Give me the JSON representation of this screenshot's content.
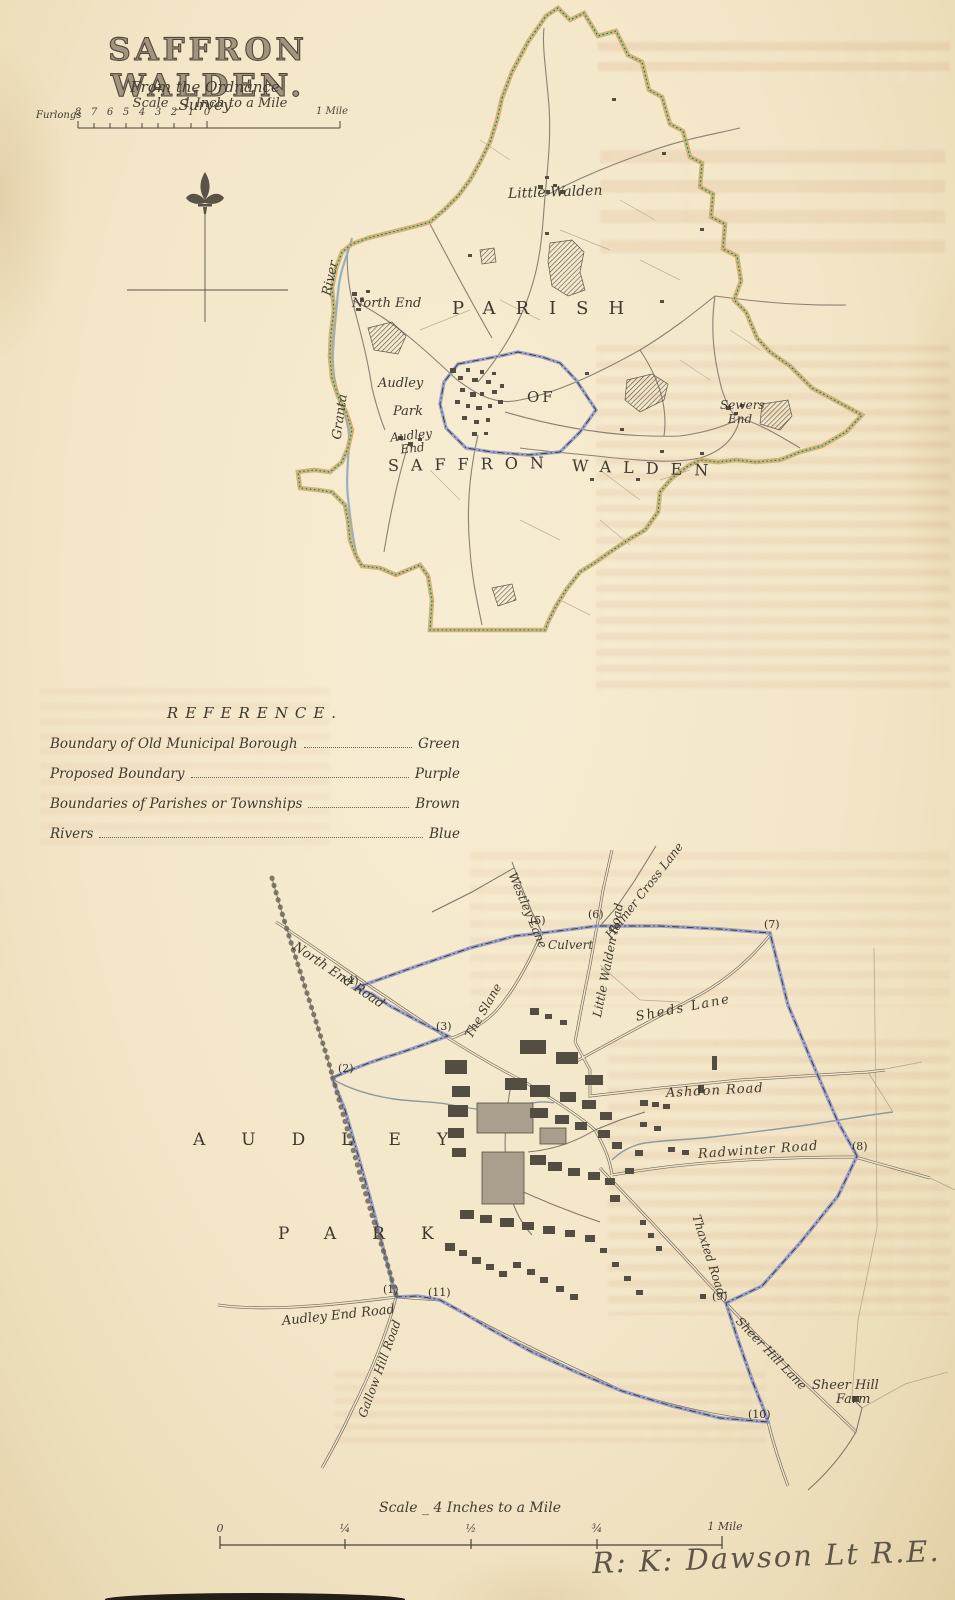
{
  "page": {
    "title": "SAFFRON WALDEN.",
    "subtitle": "From the Ordnance Survey",
    "signature": "R: K: Dawson Lt R.E."
  },
  "scale_top": {
    "label": "Scale _ 1 Inch to a Mile",
    "unit": "Furlongs",
    "ticks": [
      "8",
      "7",
      "6",
      "5",
      "4",
      "3",
      "2",
      "1",
      "0"
    ],
    "mile": "1 Mile"
  },
  "scale_bottom": {
    "label": "Scale _ 4 Inches to a Mile",
    "ticks": [
      "0",
      "¼",
      "½",
      "¾"
    ],
    "mile": "1 Mile"
  },
  "reference": {
    "heading": "REFERENCE.",
    "rows": [
      {
        "label": "Boundary of Old Municipal Borough",
        "value": "Green"
      },
      {
        "label": "Proposed Boundary",
        "value": "Purple"
      },
      {
        "label": "Boundaries of Parishes or Townships",
        "value": "Brown"
      },
      {
        "label": "Rivers",
        "value": "Blue"
      }
    ]
  },
  "parish_map": {
    "labels": {
      "river_line1": "River",
      "river_line2": "Granta",
      "north_end": "North End",
      "little_walden": "Little Walden",
      "parish": "PARISH",
      "of": "OF",
      "audley": "Audley",
      "park": "Park",
      "audley_end": "Audley End",
      "saffron": "SAFFRON",
      "walden": "WALDEN",
      "sewers": "Sewers",
      "end": "End"
    }
  },
  "town_map": {
    "roads": {
      "north_end_road": "North End Road",
      "the_slane": "The Slane",
      "westley_lane": "Westley Lane",
      "little_walden_road": "Little Walden Road",
      "holmer_cross_lane": "Holmer Cross Lane",
      "sheds_lane": "Sheds Lane",
      "ashdon_road": "Ashdon Road",
      "radwinter_road": "Radwinter Road",
      "thaxted_road": "Thaxted Road",
      "audley_end_road": "Audley End Road",
      "gallow_hill_road": "Gallow Hill Road",
      "sheer_hill_lane": "Sheer Hill Lane",
      "culvert": "Culvert"
    },
    "places": {
      "audley": "AUDLEY",
      "park": "PARK",
      "farm_line1": "Sheer Hill",
      "farm_line2": "Farm"
    },
    "markers": {
      "m1": "(1)",
      "m2": "(2)",
      "m3": "(3)",
      "m4": "(4)",
      "m5": "(5)",
      "m6": "(6)",
      "m7": "(7)",
      "m8": "(8)",
      "m9": "(9)",
      "m10": "(10)",
      "m11": "(11)"
    }
  },
  "colors": {
    "paper": "#f3e6c8",
    "boundary_green": "#96c8a0",
    "boundary_purple": "#959cc6",
    "boundary_brown": "#6a4f30",
    "boundary_orange": "#e6a04c",
    "river_blue": "#8fa9ba",
    "ink": "#4a443a"
  }
}
